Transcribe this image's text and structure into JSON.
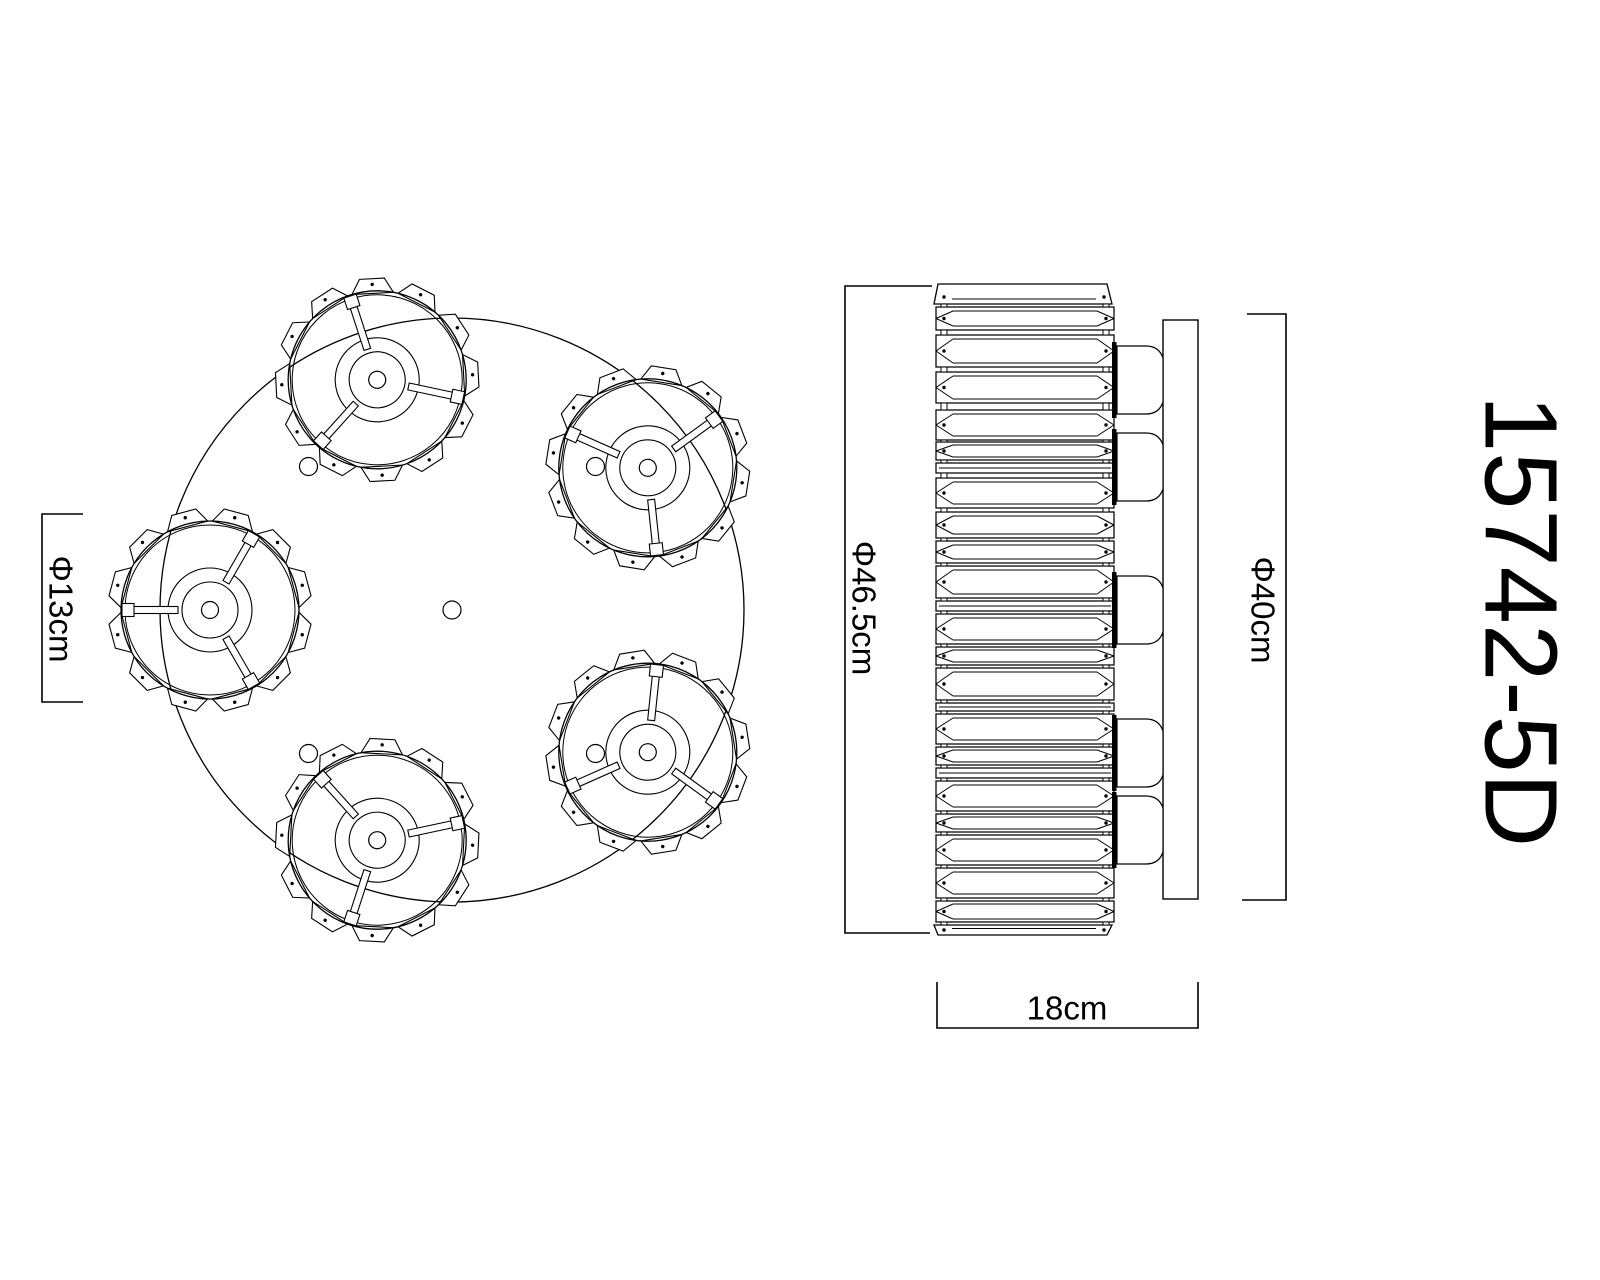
{
  "model_label": "15742-5D",
  "dimension_labels": {
    "lamp_shade": "Φ13cm",
    "body": "Φ46.5cm",
    "mount_plate": "Φ40cm",
    "depth": "18cm"
  },
  "colors": {
    "line": "#000000",
    "background": "#ffffff"
  },
  "top_view": {
    "center": [
      452,
      610
    ],
    "body_radius": 292,
    "lamp_ring_radius": 242,
    "lamp_angles_deg": [
      108,
      36,
      180,
      252,
      324
    ],
    "lamp": {
      "rim_radius": 89,
      "rim_inner_radius": 85,
      "ring1_radius": 42,
      "ring2_radius": 28,
      "hub_radius": 8.5,
      "spoke_from": 32,
      "spoke_to": 86,
      "spoke_width": 7,
      "spoke_count": 3,
      "crystal_count": 12,
      "crystal_inner": 89,
      "crystal_outer": 102
    },
    "screw_holes": {
      "ring_radius": 203,
      "angles_deg": [
        45,
        135,
        225,
        315
      ],
      "radius": 9,
      "center_hole": true
    }
  },
  "side_view": {
    "x": 936,
    "width": 178,
    "top": 284,
    "bottom": 935,
    "bars": [
      [
        284,
        20
      ],
      [
        307,
        23
      ],
      [
        335,
        32
      ],
      [
        372,
        31
      ],
      [
        410,
        30
      ],
      [
        442,
        18
      ],
      [
        463,
        10
      ],
      [
        478,
        30
      ],
      [
        512,
        26
      ],
      [
        541,
        22
      ],
      [
        566,
        32
      ],
      [
        601,
        10
      ],
      [
        614,
        30
      ],
      [
        647,
        18
      ],
      [
        668,
        32
      ],
      [
        703,
        8
      ],
      [
        714,
        30
      ],
      [
        747,
        18
      ],
      [
        768,
        10
      ],
      [
        781,
        30
      ],
      [
        814,
        18
      ],
      [
        835,
        30
      ],
      [
        868,
        30
      ],
      [
        901,
        21
      ],
      [
        925,
        10
      ]
    ],
    "cup_centers": [
      380,
      467,
      610,
      753,
      830
    ],
    "plate": {
      "x": 1163,
      "width": 35,
      "top": 320,
      "bottom": 899
    }
  },
  "dimension_geometry": {
    "shade_bracket": "M83,514 H42 V702 H83",
    "body_bracket": "M932,286 H845 V933 H930",
    "plate_bracket": "M1247,314 H1286 V900 H1242",
    "depth_bracket": "M937,982 V1028 H1198 V982"
  }
}
